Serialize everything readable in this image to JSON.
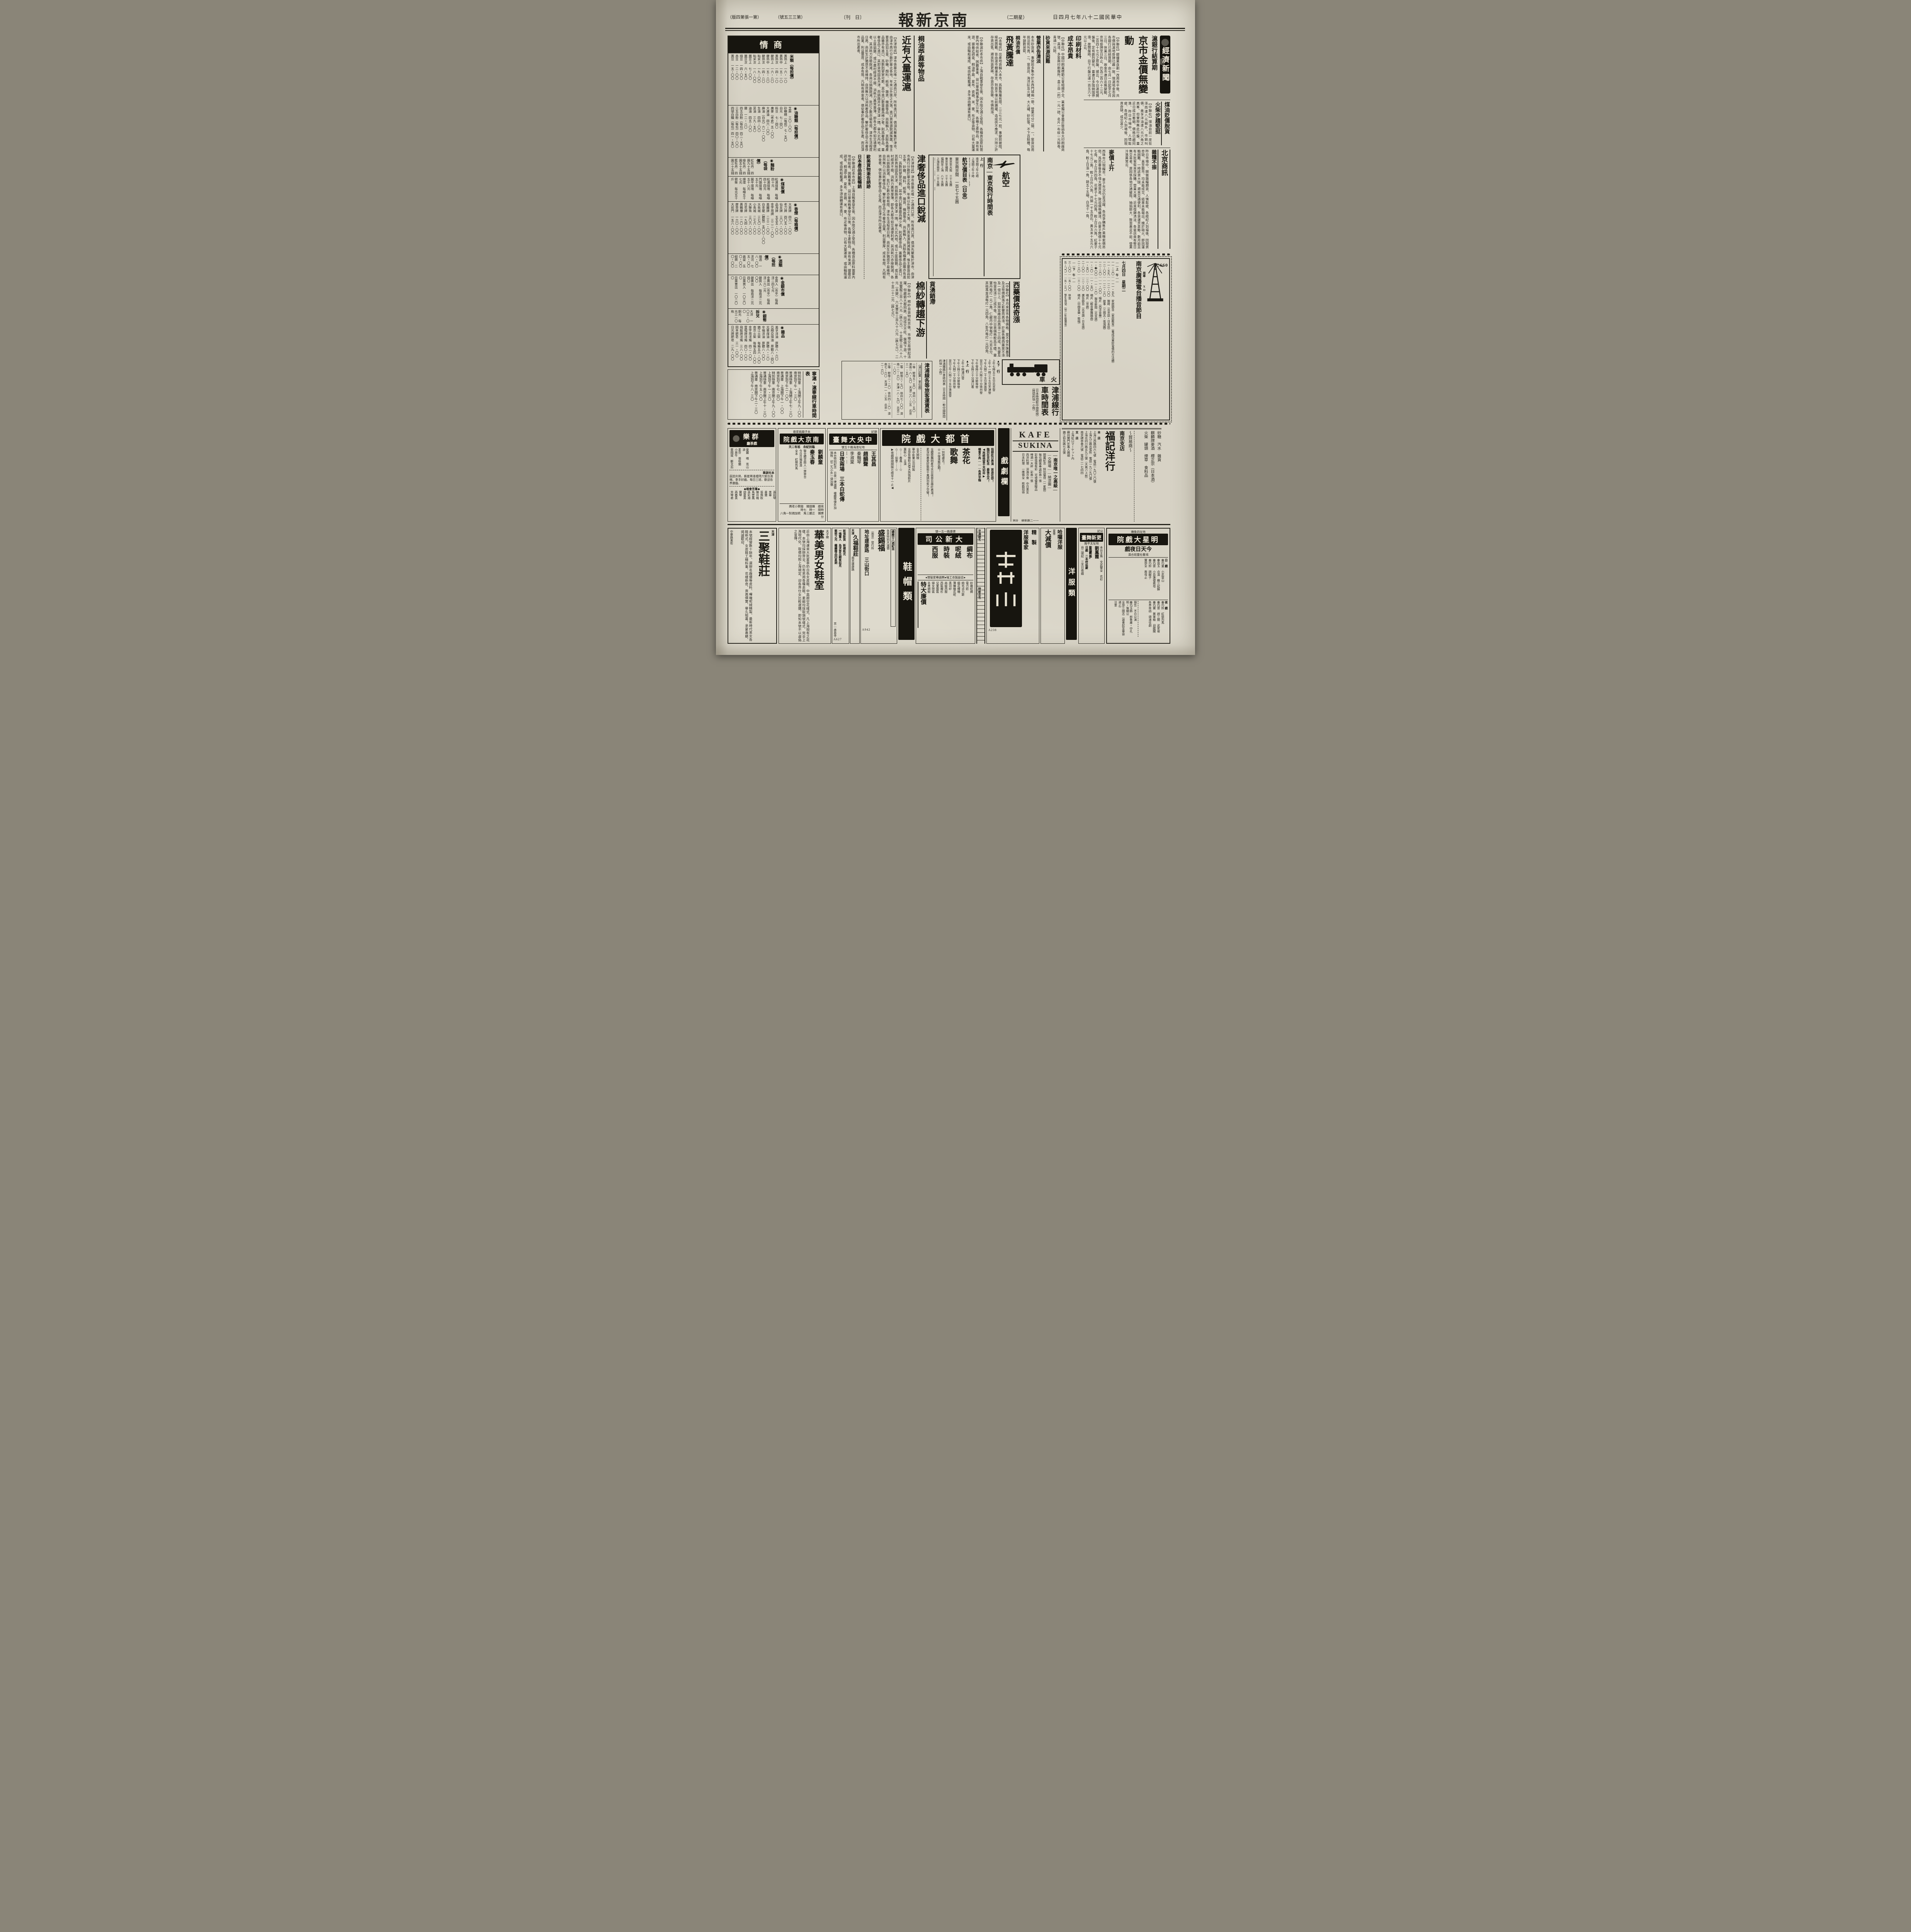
{
  "masthead": {
    "page_note": "（第一張第四版）",
    "issue": "（第三三五號）",
    "daily": "〔日　刊〕",
    "title": "南京新報",
    "weekday": "（星期二）",
    "date": "中華民國二十八年七月四日"
  },
  "market": {
    "header": "商情",
    "sections": [
      {
        "name": "米類（每担價）",
        "rows": [
          "黃熟上　一六・一〇",
          "黃熟中　一五・一〇",
          "黃熟次　一四・一〇",
          "粳熟上　一六・八〇",
          "粳熟中　一五・八〇",
          "粳熟次　一四・八〇",
          "秈米上　一九・〇〇",
          "秈米次　一八・〇〇",
          "蠶豆上　七・〇〇",
          "蠶豆次　六・五〇",
          "綠豆　一四・〇〇",
          "赤豆　一二・〇〇",
          "黃豆　一五・〇〇"
        ]
      },
      {
        "name": "◉油糖類（每担價）",
        "rows": [
          "芝蔴　三〇・〇〇",
          "砂糖精（每担）七・五〇",
          "白元　七・四〇",
          "料豆　七・四〇",
          "廣麥（老倉）五・〇〇",
          "大連油　四六・〇〇",
          "麻油（白元）六二・〇〇",
          "生油　四四・〇〇",
          "菜油　三九・五〇",
          "滷油　四五・〇〇",
          "鹽　一二・八〇",
          "四五白粉（每包）四二・五〇",
          "三五白粉（每包）四〇・〇〇",
          "四號白糖（每包）四一・五〇"
        ]
      },
      {
        "name": "◉麵粉（每袋價）",
        "rows": [
          "紅牡丹　四圓九十五錢",
          "綠牡丹　四圓五十五錢",
          "藍牡丹　四圓三十五錢"
        ]
      },
      {
        "name": "◉煤炭價",
        "rows": [
          "松浦煤屑　每噸四十元",
          "松浦煤塊　每噸四十四元",
          "門頭煤塊　每噸五十元",
          "開平煤塊　每噸五十八元",
          "煙煤　每噸五十七元",
          "劈柴　每元五十斤"
        ]
      },
      {
        "name": "◉香煙（每箱價）",
        "rows": [
          "大英牌　四六一・〇〇",
          "老刀牌　四〇五・〇〇",
          "仙女牌　三〇八・〇〇",
          "品海牌　五五五・〇〇",
          "金字塔牌　三二二・〇〇",
          "美麗牌　二三二・〇〇",
          "白金龍（聽裝）五〇〇・〇〇",
          "大長城　三七〇・〇〇",
          "小長城　二七六・〇〇",
          "大聯珠　三〇六・〇〇",
          "百花牌　一九四・〇〇",
          "黃鶴樓　一二〇・〇〇",
          "摩登牌　一六〇・〇〇",
          "大前門　一五八・〇〇"
        ]
      },
      {
        "name": "◉酒類（每担價）",
        "rows": [
          "燒酒　一八・〇〇",
          "洋河　七五・〇〇",
          "高粱　五〇・〇〇",
          "紹興　二〇・〇〇"
        ]
      },
      {
        "name": "◉金銀市價",
        "rows": [
          "金買入（市平）每兩洋二四七元",
          "金賣出（市平）每兩洋二六二元",
          "銀買入　每兩洋二元〇〇",
          "銀賣出　每兩洋二元四〇",
          "日票買入　一〇三〇〇",
          "日票賣出　一〇二〇〇"
        ]
      },
      {
        "name": "◉銀幣拆兌",
        "rows": [
          "大洋　一〇三・〇〇",
          "銅元　每元三一〇枚"
        ]
      },
      {
        "name": "◉雜品",
        "rows": [
          "美孚洋油　原聽八・六〇",
          "亞細亞煤油　原聽八・四〇",
          "光華煤油　原聽八・二〇",
          "辛福洋油　原聽八・〇〇",
          "鎮江火柴　每箱五六・〇〇",
          "南京火柴　每箱五四・〇〇",
          "金字塔洋燭　四二・〇〇",
          "雷帽牌洋燭　四〇・〇〇",
          "飛艇牌洋燭　三八・〇〇",
          "固本肥皂　三一・〇〇",
          "日光牌肥皂　二九・〇〇"
        ]
      }
    ]
  },
  "shanghai_line": {
    "title": "寧滬・滬寧線行車時間表",
    "rows": [
      "特別快車　上海開上午九・〇〇　南京到下午一・三〇",
      "普通快車　上海開上午七・三〇　南京到下午二・〇〇",
      "普通車　上海開下午一・〇〇　南京到下午七・四〇",
      "特別快車　南京開上午九・〇〇　上海到下午一・三〇",
      "普通快車　南京開上午十・三〇　上海到下午五・〇〇",
      "普通車　南京開下午二・三〇　上海到下午八・三〇"
    ]
  },
  "economy": {
    "logo": "經濟新聞",
    "kicker": "滬銀行結算期",
    "headline": "京市金價無變動",
    "body": "【中聯社】銀樓業自劃一改用市平後、共市價與滬地掛牌已趨一致、現滬地金市因各銀行已屆結算期、由七月一日起至七月三日、休業三日、故金市連日迄無變動、京地掛牌至日昨止、仍為二百六十二元、二百四十七元之原盤、據云、今日滬地開盤後、定有劇烈變化、蓋連日多囤納囤停滯、故開盤時、目下行盤已達一百五六十元以上云、",
    "oil_head": "煤油貶價脫貨",
    "match_head": "火柴步趨堅挺",
    "sub_body": "【中聯社】煤油自前一度狂漲而達八元關外、市銷叫價、美孚洋油達八元六角之高峯、但實際無此行盤、蓋近日成交萎縮、價格已趨囘落、昨日市場中、人情鬆疲、各經紀人到場後、因現貨奇缺、成交甚少、",
    "bj_title": "北京商訊",
    "bj_sub": "雜糧不振",
    "bj_body": "昨日市場中、開做雜糧期貨、人情鬆疲、各經紀人到場後、因現貨奇缺、直至散市、均未能成交、結果未能報出、媿於砲火、即因運輸困難、一時該貨大缺、邇來交通便利、各貨運京甚夥、數月前且有大批客幫來京採購、營業大盛、近來復歸淸淡、各窰店竟有整日無交易者、原因係各地交通破阻、抽捐鉅大、致皆裹足不前、營業冷落異常云、",
    "wheat_head": "麥價上升",
    "wheat_body": "西珠市口現糧市、麥子市況仍呈活躍、各商爭購售戶乘機索價昂俏、爲恐審後多不惜大價買進、致迫價格續漲、白麥子開價十七元七角、較上日升四角、花麥子十七元四角、較上日升六角、紅麥子十七元二角、較上日升六角、共銷一千五百石、黃玉米十五元六角、較上日漲一角、銷五十五噸、白泡十一角、"
  },
  "printing": {
    "h1": "印刷材料",
    "h2": "成本昂貴",
    "body": "【中聯社】中國印刷業模範公會組織不全、業者獨公會最近致函各大印刷廠商號、高漲、多家興印刷廠所、盒三自（約）一元一磅、名片一布紋一元餘卷、青通一元餘、",
    "sand1": "砂貨來源困難",
    "sand2": "營業亦告清淡",
    "body2": "本市砂貨業、事變前多集中於水西門城廂一帶、營業可分二類、一、窰貨店用挑沿街叫賣、二、窰貨店、海洋缸及火罐、大火罐、砂缸等、不下百餘種、每年銷數甚鉅、"
  },
  "tung": {
    "h1": "桐油市價",
    "h2": "飛黃騰達",
    "body": "【本報訊】出產地貨輛入本市、爲數殊屬有限、二三七元一担、事變前被阻、極感困難、皆由滬市轉運來京、到貨不僅以前踴躍、造成供不應求、只持少許存貨出售、邇來到貨更稀、存貨亦皆告罄、市價飛漲、"
  },
  "shipments": {
    "h1": "桐油苧蔴等物品",
    "h2": "近有大量運滬",
    "body": "【中聯滬社本市訊】上海自戰事發生後、因水陸交通之受阻、各種貨品原料需要內地供給者、困難重重、益以華南戰事發生以後、各種土產物品、漸有來源、據最近調查、桐油苧蔴、夏布、瓷器、米、麥、布疋等貨物、已有大量運來、或由輪船運成、或由帆船載運、多半須由轉運有進口、"
  },
  "luxury": {
    "head": "津奢侈品進口銳減",
    "sub1": "歐美貨物漸告絕跡",
    "sub2": "日本產品尚能暢銷",
    "body": "【天津特訊】津市係華北唯一之通商口岸、所有進口貨、俱須先聚集於津市、由津市再行分散於華北各地、年來以外匯之大落、進口貨來源銳減殊厲、惟主要貨品如五金、砂糖、顏料、紙張、雜貨、機器等品、尚能輸入、其餘各種產品雖亦有進口、爲數則寥寥可數、其中進口數量最爲稀少者、則爲奢侈品、蓋奢侈品之進口、其卸貨地固爲天津、而銷路并不僅天津一隅、舉凡北內地、或以土匪猖獗、或以農村經濟不振、消耗力異常單薄、即各大都市如交通便利者、其消耗力亦極銳減、各商以銷路銳減、批訂之數亦極有限、津市生活程度日高、商民生計猶感不易維持、自然無力以消耗奢侈品、鑒於奢侈品之市奢侈品業、利益豐厚、成本有限、凡稍有資金者、俱從事於奢侈品之生產、而且津市所出產者、"
  },
  "aviation": {
    "brand": "航空",
    "title": "南京—東京飛行時間表",
    "up_label": "上　行",
    "down_label": "下　行",
    "up_lines": [
      "南京開上午七時",
      "上海開上午十時",
      "東京到下午五時十五分"
    ],
    "down_lines": [
      "東京開下午二時五分",
      "上海開下午四時十分",
      "南京到下午四時十五分（折回上海）"
    ],
    "fare_title": "航空價目表（日金）",
    "fare_main": "東京南京間　一百七十五圓",
    "fares": [
      "東京至大阪　三十五圓",
      "東京至福岡　三十五圓",
      "福岡至上海　八十五圓",
      "上海至南京　二十五圓",
      "南京——徐州　四十五圓",
      "徐州——濟南　四十圓",
      "濟南——天津　四十五圓",
      "天津——北京　十五圓（全程一百四十五圓）"
    ],
    "legs": [
      "上海開　九・三〇",
      "南京到　一一・〇五",
      "南京開　一一・一五",
      "徐州開　一二・〇〇",
      "濟南到　一三・〇〇",
      "濟南開　一三・二〇",
      "天津到　一四・二〇",
      "天津開　一四・三〇",
      "北京到　一五・〇〇"
    ],
    "hankou": [
      "漢口——上海（下行）漢口開十三・三〇",
      "上海——漢口（上行）上海開九・五〇分"
    ]
  },
  "cotton": {
    "h1": "貨湧銷滯",
    "h2": "棉紗轉趨下游",
    "body": "【中聯社】棉紗自貨物抵京後、市場交易頓起活躍、但趨勢大都囘跌、因成交不旺、盤價下游、十支雙龍三百八十八元（跌六元）、十支龍三百八十八元（未變）、六支豐年三百九十六元（跌七元）、二十支二十二元（跌七元）、"
  },
  "medicine": {
    "head": "西藥價格奇漲",
    "body": "【中聯社】本月來京市各物價格、莫不受外匯暴漲及法幣價跌落之影響而高漲、於是各種西藥莫不漲及一倍以上、如拜耳廠出品高漲二三四成、先靈及怡里克漲二三成不等、現只日貨價格較爲平穩、靈寶丹每打一元二角、仁龍丹中號每打一元另五分、其他萬金油每打一元四角、八卦丹每打一元四角、"
  },
  "jinpu": {
    "side": "津浦鐵路行車時刻表（日本時間—較中國時間約快一小時）",
    "brand": "火　車",
    "title": "津浦線行車時間表",
    "note": "（日本時間較中國時間）（時間約快一小時）",
    "down_label": "▲下　行",
    "down": [
      "上午七時五十五分北京發",
      "上午十一時三十五分天津發",
      "下午九時二十五分濟南發",
      "翌日上午六時三十分徐州發",
      "下午零時三十分蚌埠發",
      "下午五時三十分浦口着"
    ],
    "up_label": "▲上　行",
    "up": [
      "上午十時浦口發",
      "下午三時三十分蚌埠發",
      "下午九時二十分徐州發",
      "翌日上午八時二十五分濟南發",
      "下午三時天津着",
      "下午五時北京着"
    ]
  },
  "fare_table": {
    "title": "津浦線各等旅客運賃表",
    "note": "（浦口起算・單位圓）",
    "rows": [
      "一等　蚌埠五・五〇　徐州一〇・五〇　濟南一八・九〇　天津二八・三五　北京三一・五〇",
      "二等　蚌埠三・七〇　徐州七・〇〇　濟南一二・六〇　天津一八・九〇　北京二一・〇〇",
      "三等　蚌埠二・二〇　徐州四・二〇　濟南七・六〇　天津一一・三五　北京一二・六〇"
    ]
  },
  "radio": {
    "title": "南京廣播電台播音節目",
    "callsign": "JC660",
    "freq_label": "周率",
    "band": "XO",
    "date": "七月四日　星期二",
    "am": "——上　午——",
    "pm": "——下　午——",
    "programs": [
      "一一・三〇——一一・五九　家庭節目（家庭教育）（養成兒童好習慣的方法續）",
      "一一・五九——一二・〇〇　報時（北京話・日本話）",
      "一二・〇〇——一二・三〇　故事（三國志・張鴻圖）",
      "一二・三〇——一・〇〇　唱片（西洋音樂）",
      "一・�〇〇——一・二〇　報告新聞（北京語）",
      "一・二〇——一・五〇　唱片（輕音樂舞踏曲）",
      "一・五〇——二・〇〇　唱片（京劇）",
      "二・〇〇——二・三〇　廣告節目（北京語・日本語）",
      "二・三〇——三・〇〇　唱片（中國音樂・歌唱）"
    ],
    "programs2": [
      "三・〇〇——五・〇〇　休音",
      "五・〇〇——五・三〇　學生時間（附二年級講座）",
      "五・三〇——六・〇〇　家庭節目",
      "六・〇〇——六・二五　唱片（京劇）",
      "六・二五——六・四五　報告新聞（日本語）",
      "六・四五——七・〇〇　報告新聞（北京語）",
      "七・〇〇——七・三〇　演藝（北京語）",
      "七・三〇——八・三〇　慰安節目",
      "八・三〇——九・〇〇　唱片（西洋音樂）",
      "九・〇〇——九・二五　音樂",
      "九・二五——九・五〇　唱片（歌唱）",
      "九・五〇——一〇・〇五　報告新聞",
      "一〇・〇五——一〇・一〇　明日節目預告"
    ]
  },
  "drama_banner": "戲劇欄",
  "capital": {
    "name": "首都大戲院",
    "right": [
      "指期赴日表演　首途在即！",
      "臨別在京紀念　最後五天！",
      "◀再經挽留不克如命▶",
      "機會不再———各界早臨"
    ],
    "troupe": [
      "茶花",
      "歌舞",
      "劇團"
    ],
    "left": [
      "一別他處去！",
      "◎◎復逢無定期！"
    ],
    "center": [
      "全體歌舞明星今天日夜登台雄壯表演！",
      "素深仰慕愛好藝術千萬請勿失之交臂！"
    ],
    "film": [
      "全天開映",
      "華中影業公司特製",
      "全部有聲對白偉大熱情鉅片",
      "葉秋心　主演",
      "☆⋯⋯春風⋯⋯☆",
      "☆⋯⋯如意⋯⋯☆",
      "▶夜戲時間開映七時至十一止◀"
    ]
  },
  "central": {
    "tag": "錦記",
    "name": "中央大舞臺",
    "addr": "地址淮海路十五號",
    "stars1": [
      "王其昌",
      "趙韻聲",
      "琴雪豔"
    ],
    "stars2": [
      "秦豔琴",
      "李淑棠",
      "郭少華",
      "劉榮春"
    ],
    "show": "日夜兩場　三本白蛇傳",
    "note": "本台特別紀念　日夜一律減價　樓廳等號外加捐稅　初二九小外一律加價"
  },
  "nanjing": {
    "addr": "夫子廟姚家巷",
    "name": "南京大戲院",
    "note": "臨別紀念　祇有二天",
    "stars": [
      "劉麟童",
      "秦玉春",
      "孫君萍",
      "花翠蘭"
    ],
    "lines": [
      "曁全體百餘人一齊登台",
      "今日日場准演",
      "全本　紅鬃烈馬"
    ],
    "night": "夜戲　雁翅關　鎗斃小老媽",
    "times": "時間　一時　七時",
    "price": "票價　正廳三角　統加捐對一角八分"
  },
  "qunle": {
    "name": "群樂",
    "sub": "戲茶廳",
    "list": [
      "曼麗　唱　荒山淚",
      "素芬　張桂蘭　小放牛",
      "蔡國斌　斷太后"
    ],
    "notice_t": "本社啟事",
    "notice": "茲因炎熱、藝星兩逢禮拜六登台演唱、拿手好戲、每日三班、歡迎各界惠臨、",
    "chorus_t": "◆羣芳會唱◆",
    "singers": [
      "黃桂秋",
      "趙美弟",
      "王美英",
      "朱芳英",
      "王英斌",
      "蔡國雲",
      "呂筠霞",
      "陳珠玉",
      "富貴花",
      "彩秋",
      "春秋",
      "麗君",
      "彭麗君",
      "林梅君",
      "筱美玉",
      "孫彩琴",
      "美華",
      "曼雅",
      "張佩秋",
      "陳月梅",
      "馬雲鳳",
      "孫彩湘",
      "胡曼英",
      "寶琴",
      "燕春英",
      "芳琴君"
    ]
  },
  "kafe": {
    "l1": "KAFE",
    "l2": "SUKINA",
    "tag": "—南京唯一之高級—",
    "sub": "—交際場——納涼園—",
    "lines": [
      "開幕紀念　特別優待（一星期）",
      "每位顧客奉送彩券一張",
      "彩券張張有彩　可得優美贈品",
      "啤酒一大杯　彩券一張",
      "西洋料理　洋酒冷食　中日美女",
      "日本料理　一應俱全　慇勤招待"
    ],
    "addr": "地址　維新路二一一",
    "tel": "電話　二一五〇九",
    "code": "A289"
  },
  "fuji": {
    "g1": "砂糖　汽水　雜貨",
    "g2": "麒麟牌麥酒　櫻正宗（日本酒）",
    "g3": "火柴　罐頭　煙草　食料品",
    "role": "～貿易商～",
    "branch": "南京支店",
    "name": "福記洋行",
    "main_label": "本　店",
    "addrs": [
      "上海江西路四六七號　電話一九〇二〇號",
      "上海九江路出張所　電話一九二九〇號",
      "上海北四川路五九三號（大直バス前）",
      "南京碑亭巷六號　電話二一七四四"
    ],
    "br_label": "支　店",
    "branches": [
      "上海虹口マーケット內",
      "蘇州閶門外萬人碼頭",
      "鎮江伯先路七五號",
      "大阪市東區道修町一、四",
      "渡邊兵站市場內　三一八〇・三一八一番"
    ]
  },
  "mingxing": {
    "addr": "地址四象橋",
    "name": "明星大戲院",
    "today": "今天日夜戲",
    "troupe": "鴻春社童班合演",
    "day_l": "日　戲",
    "day": [
      "秦巧童　小武當山",
      "秦良玉　合演　蘇三起解",
      "秦巧雲　小目蓮僧救母",
      "秦巧鈴　調解子",
      "寶部全　救母止"
    ],
    "night_l": "夜　戲",
    "night": [
      "秦巧鈴　紅鬃烈馬",
      "秦巧雲　趕三關　武家坡",
      "秦巧寶　算軍粮　迴龍閣",
      "各界來函　頌演佳劇"
    ],
    "notice": [
      "預告　不日公演",
      "秦巧玉飾　前魯肅・中孔明・後關公",
      "全部三國志（盜書起至華容道止）",
      "注意"
    ]
  },
  "gengxin": {
    "tag": "公記",
    "name": "更新舞臺",
    "addr": "地址太平路",
    "cast": "本台主角　文武雙全　花衫",
    "stars": [
      "劉鳳霞",
      "蓋蘭亭",
      "于占元"
    ],
    "day": "日戲　二本呼延慶",
    "note": "自二號起　三天日夜戲"
  },
  "banners": {
    "yangfu": "洋服類",
    "xiemao": "鞋帽類"
  },
  "halo": {
    "name": "哈囉洋服",
    "season": "夏季",
    "sale": "大減價",
    "addr": "地址　太平路一九七號・一四九號",
    "lines": [
      "花式繁多　內襯豐富",
      "聽君揀愛　包不走樣",
      "工作優美　價目低廉",
      "式樣驚奇　歡迎比較"
    ]
  },
  "tailor": {
    "lines": [
      "精　製",
      "洋服專家",
      "大批運到"
    ],
    "code": "A238"
  },
  "strip": {
    "t1": "京滬馳名",
    "t2": "時新花色"
  },
  "daxin": {
    "name": "大新公司",
    "addr": "建康路一五一號",
    "cats": [
      "綢布",
      "呢絨",
      "時裝",
      "西服"
    ],
    "note": "●自設製衣工場●聘請專家管理●",
    "items": [
      "紗羅紡綢",
      "電力紡",
      "純毛派力斯",
      "縐花嗶嘰",
      "薄嗶嘰花呢",
      "黑司紗",
      "高級西服",
      "西裝襯衫",
      "兒童服裝",
      "婦女時裝",
      "名貴綢緞",
      "時代布匹"
    ],
    "banner": "特大廉價"
  },
  "shengxifu": {
    "anniv": "總廠廿八週紀念",
    "sale": "各貨特別大減價",
    "name": "盛錫福",
    "branch": "（南京）發行所",
    "addr": "地址建康路　三山街口",
    "dealers": [
      "經銷處",
      "珠江路鑫記帽行",
      "新街口大華帽行"
    ],
    "code": "A942"
  },
  "jiufu": {
    "city": "天津",
    "name": "久福鞋莊",
    "addr": "南京建康路"
  },
  "yiming": {
    "lines": [
      "新張新貨　新樣新式",
      "一鳴驚人　為求普及顧客起見",
      "藝術之光　繼續贈品四星期"
    ],
    "addr": "京—承恩寺",
    "code": "A627"
  },
  "huamei": {
    "place": "夫子廟",
    "name": "華美男女鞋室",
    "body": "近由上海運來大批夏季奶白色女皮鞋、中高跟空花樣式、凡上海現有之花樣、本號均採辦齊全、仍有男用各種走鞋、素緞均採取頭號樣式、完全上海現代化、取價均照上海規定、迎各界仕女比較選購、即知本號不以虛偽之宣傳、"
  },
  "sanju": {
    "city": "天津",
    "name": "三聚鞋莊",
    "addr": "中華路東街",
    "body": "本號經營數十餘年、選辦名廠優等皮料、嗶嘰呢絨精製、最新時代男女各鞋新式、女皮鞋工精料重、花樣新奇、貨高價實、譽久昭著、承蒙惠顧、竭誠歡迎、"
  }
}
